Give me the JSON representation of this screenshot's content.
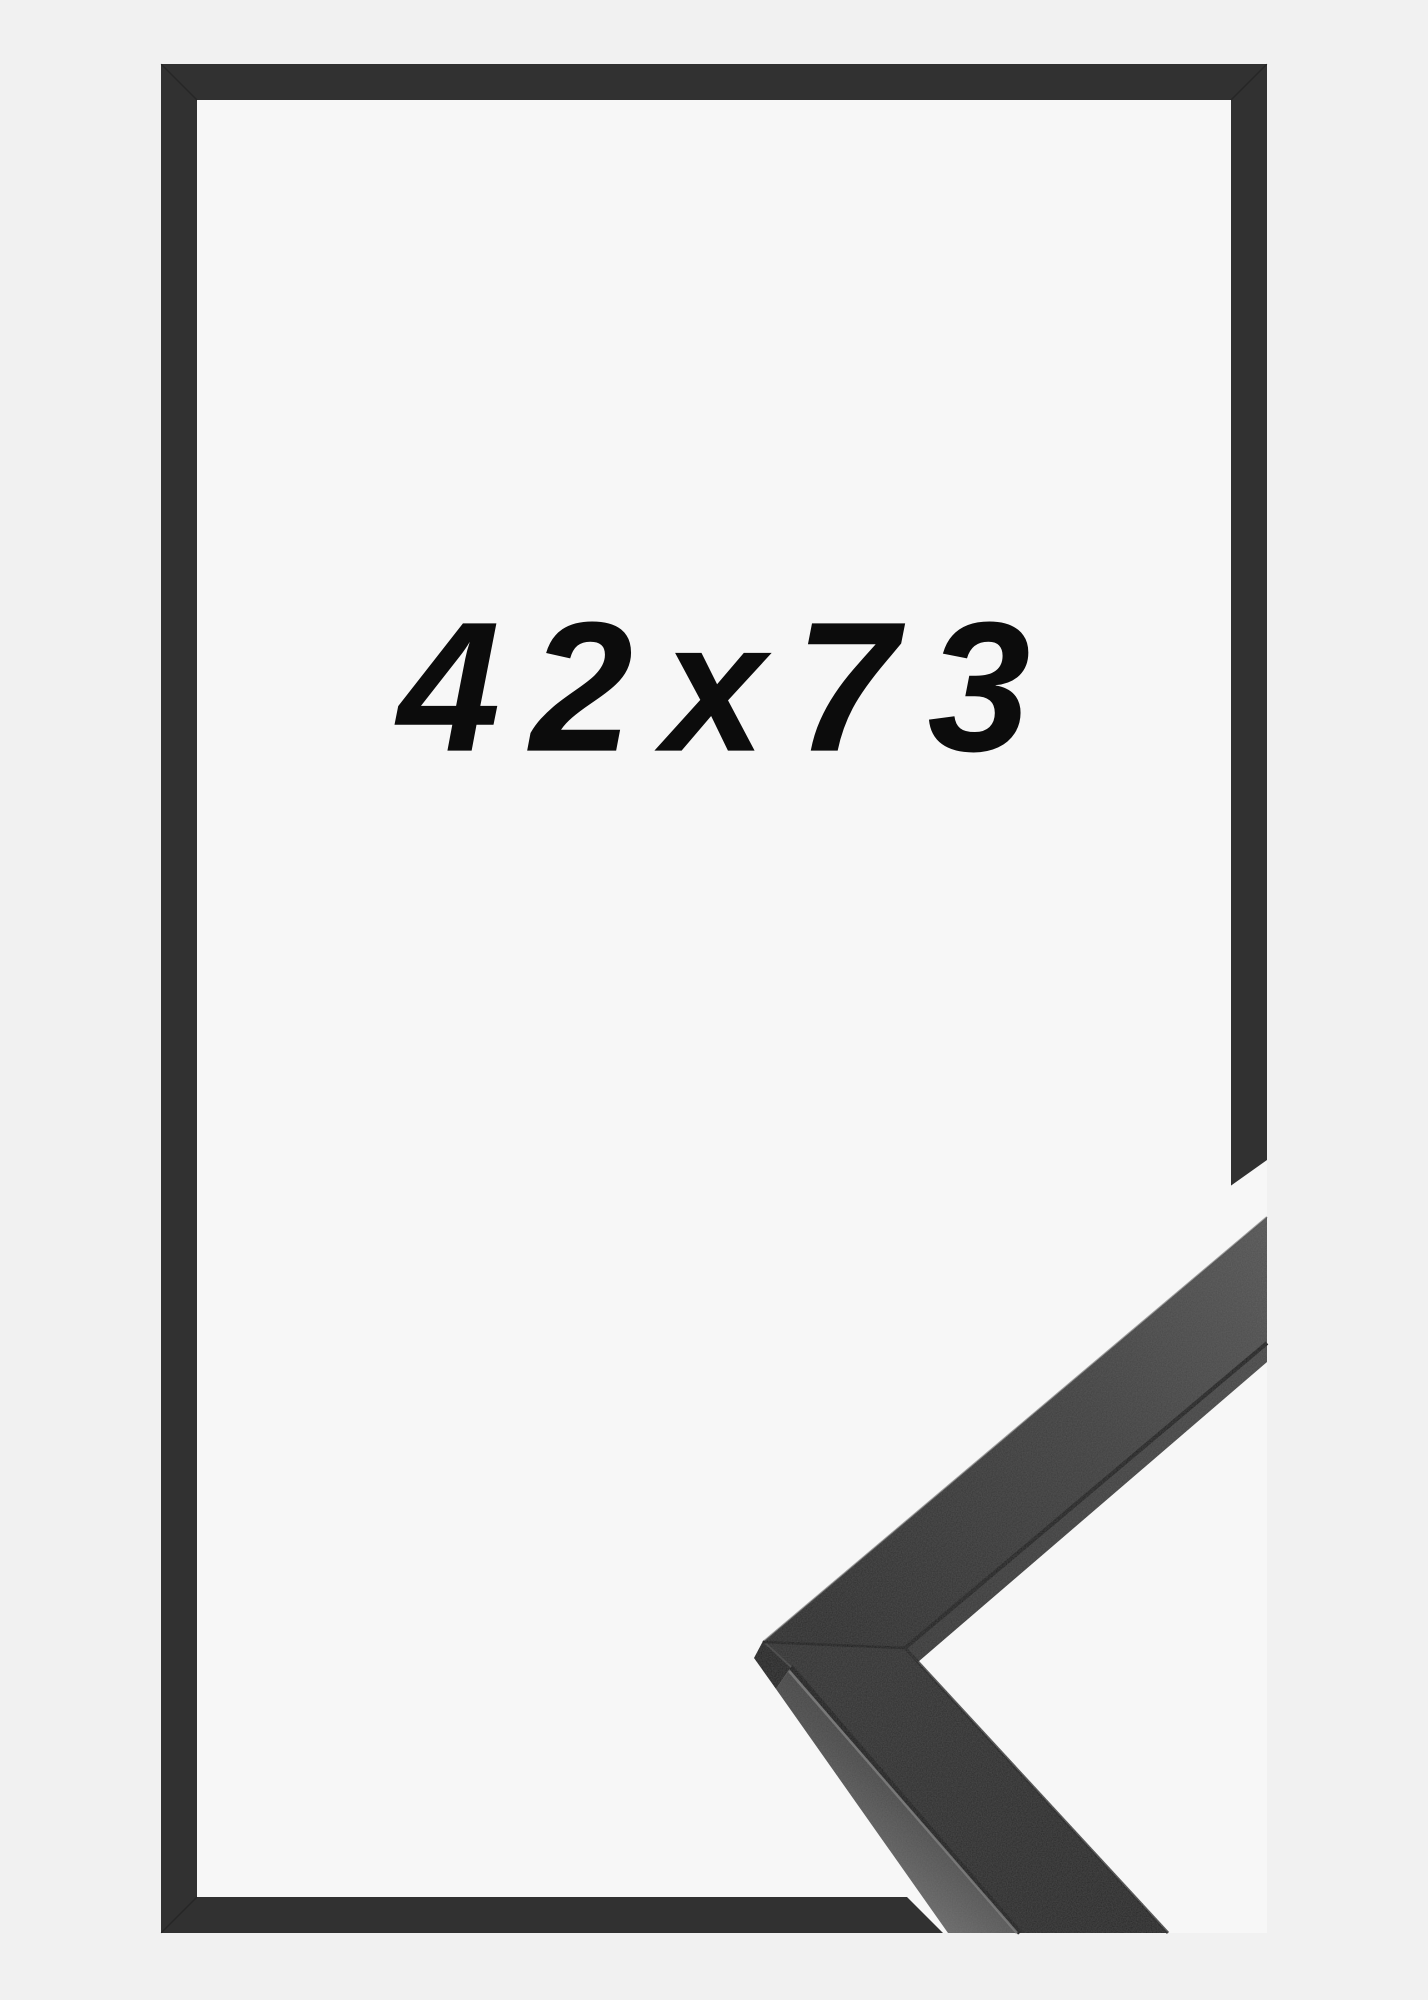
{
  "product": {
    "size_label": "42x73"
  },
  "colors": {
    "bg_outer": "#f1f1f1",
    "bg_inner": "#f7f7f7",
    "frame": "#313131",
    "label": "#0c0c0c",
    "sample_face_dark": "#292929",
    "sample_face_light": "#535353",
    "sample_side_light": "#6e6e6e",
    "sample_side_dark": "#3c3c3c",
    "sample_crease": "#151515"
  }
}
